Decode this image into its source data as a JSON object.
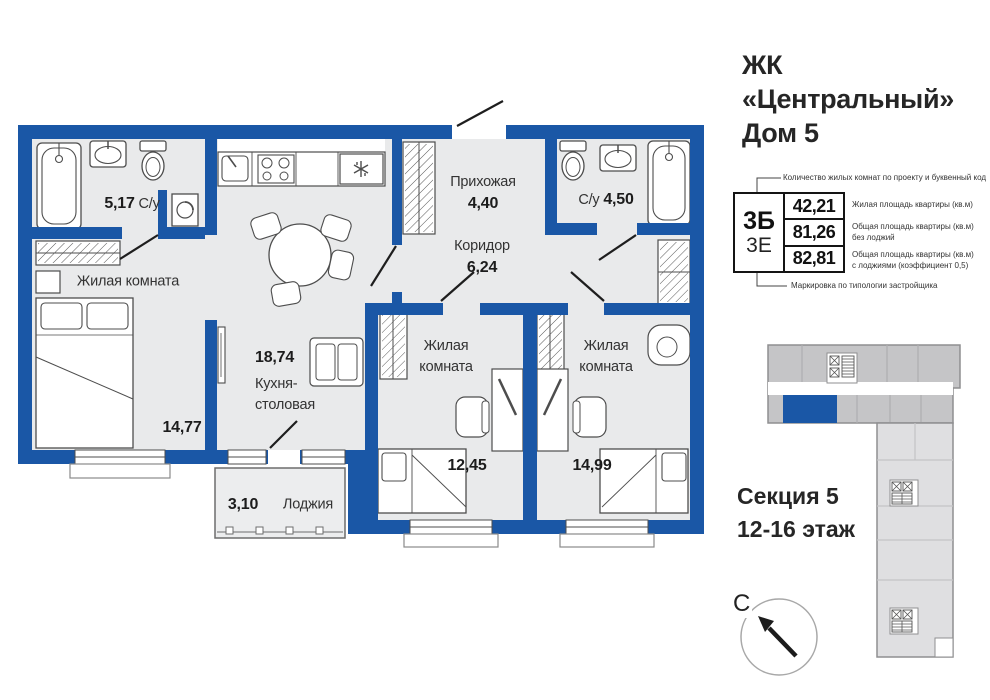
{
  "header": {
    "line1": "ЖК",
    "line2": "«Центральный»",
    "line3": "Дом 5"
  },
  "spec": {
    "top_note": "Количество жилых комнат по проекту и буквенный код",
    "code_primary": "3Б",
    "code_secondary": "3Е",
    "rows": [
      {
        "value": "42,21",
        "note1": "Жилая площадь квартиры (кв.м)"
      },
      {
        "value": "81,26",
        "note1": "Общая площадь квартиры (кв.м)",
        "note2": "без лоджий"
      },
      {
        "value": "82,81",
        "note1": "Общая площадь квартиры (кв.м)",
        "note2": "с лоджиями (коэффициент 0,5)"
      }
    ],
    "bottom_note": "Маркировка по типологии застройщика"
  },
  "rooms": {
    "bath1": {
      "area": "5,17",
      "name": "С/у"
    },
    "living": {
      "name": "Жилая комната",
      "area": "14,77"
    },
    "kitchen": {
      "area": "18,74",
      "name_line1": "Кухня-",
      "name_line2": "столовая"
    },
    "hall": {
      "name": "Прихожая",
      "area": "4,40"
    },
    "corridor": {
      "name": "Коридор",
      "area": "6,24"
    },
    "bath2": {
      "name": "С/у",
      "area": "4,50"
    },
    "bedroom1": {
      "name_line1": "Жилая",
      "name_line2": "комната",
      "area": "12,45"
    },
    "bedroom2": {
      "name_line1": "Жилая",
      "name_line2": "комната",
      "area": "14,99"
    },
    "loggia": {
      "area": "3,10",
      "name": "Лоджия"
    }
  },
  "section": {
    "line1": "Секция 5",
    "line2": "12-16 этаж"
  },
  "compass": {
    "north_label": "С"
  },
  "colors": {
    "wall_blue": "#1a57a6",
    "floor_gray": "#e9eaeb",
    "keyplan_dark_gray": "#c5c5c7",
    "keyplan_light_gray": "#dfdfe1",
    "outline_gray": "#8f8f91"
  }
}
